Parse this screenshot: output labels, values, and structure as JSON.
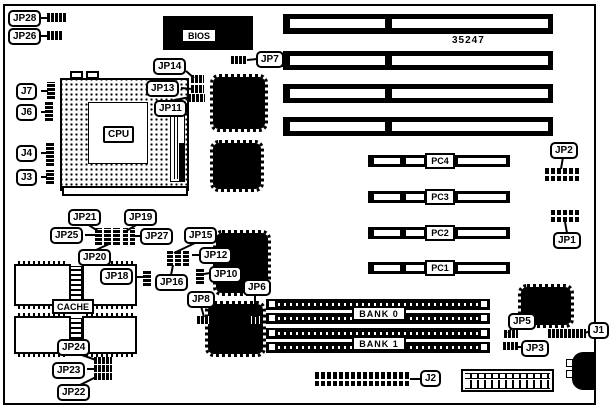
{
  "figure": {
    "board_number": "35247"
  },
  "colors": {
    "ink": "#000000",
    "paper": "#ffffff"
  },
  "labels": {
    "jp28": "JP28",
    "jp26": "JP26",
    "j7": "J7",
    "j6": "J6",
    "j4": "J4",
    "j3": "J3",
    "jp14": "JP14",
    "jp13": "JP13",
    "jp11": "JP11",
    "jp7": "JP7",
    "jp2": "JP2",
    "jp1": "JP1",
    "jp21": "JP21",
    "jp19": "JP19",
    "jp25": "JP25",
    "jp27": "JP27",
    "jp20": "JP20",
    "jp15": "JP15",
    "jp12": "JP12",
    "jp18": "JP18",
    "jp16": "JP16",
    "jp10": "JP10",
    "jp8": "JP8",
    "jp6": "JP6",
    "jp24": "JP24",
    "jp23": "JP23",
    "jp22": "JP22",
    "jp5": "JP5",
    "jp3": "JP3",
    "j1": "J1",
    "j2": "J2",
    "cpu": "CPU",
    "bios": "BIOS",
    "cache": "CACHE",
    "bank0": "BANK 0",
    "bank1": "BANK 1",
    "pc1": "PC1",
    "pc2": "PC2",
    "pc3": "PC3",
    "pc4": "PC4"
  }
}
